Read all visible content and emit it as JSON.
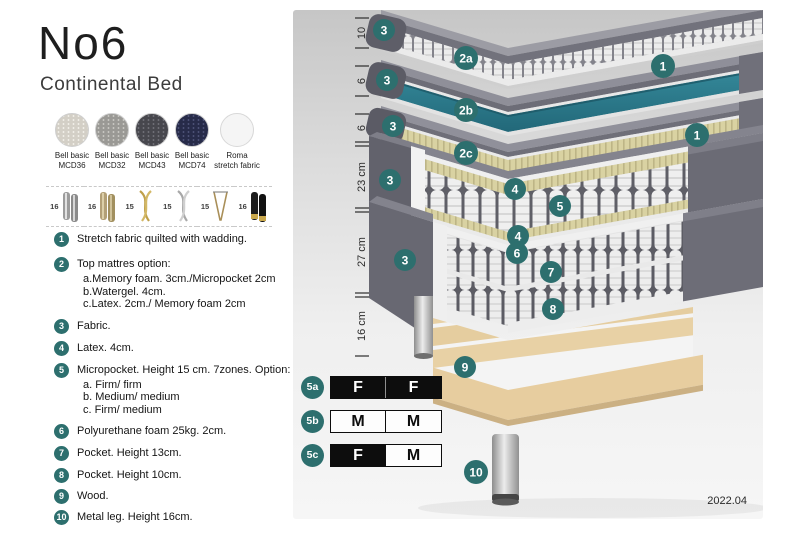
{
  "header": {
    "title": "No6",
    "subtitle": "Continental Bed"
  },
  "fabrics": [
    {
      "line1": "Bell basic",
      "line2": "MCD36"
    },
    {
      "line1": "Bell basic",
      "line2": "MCD32"
    },
    {
      "line1": "Bell basic",
      "line2": "MCD43"
    },
    {
      "line1": "Bell basic",
      "line2": "MCD74"
    },
    {
      "line1": "Roma",
      "line2": "stretch fabric"
    }
  ],
  "legs": [
    {
      "height": "16",
      "icon": "cylinder-silver-leg-icon"
    },
    {
      "height": "16",
      "icon": "cylinder-wood-leg-icon"
    },
    {
      "height": "15",
      "icon": "twist-gold-leg-icon"
    },
    {
      "height": "15",
      "icon": "twist-silver-leg-icon"
    },
    {
      "height": "15",
      "icon": "hairpin-leg-icon"
    },
    {
      "height": "16",
      "icon": "cylinder-black-gold-leg-icon"
    }
  ],
  "features": [
    {
      "num": "1",
      "text": "Stretch fabric quilted with wadding.",
      "sub": []
    },
    {
      "num": "2",
      "text": "Top mattres option:",
      "sub": [
        "a.Memory foam. 3cm./Micropocket 2cm",
        "b.Watergel. 4cm.",
        "c.Latex. 2cm./ Memory foam 2cm"
      ]
    },
    {
      "num": "3",
      "text": "Fabric.",
      "sub": []
    },
    {
      "num": "4",
      "text": "Latex. 4cm.",
      "sub": []
    },
    {
      "num": "5",
      "text": "Micropocket. Height 15 cm. 7zones. Option:",
      "sub": [
        "a. Firm/ firm",
        "b. Medium/ medium",
        "c. Firm/ medium"
      ]
    },
    {
      "num": "6",
      "text": "Polyurethane foam 25kg. 2cm.",
      "sub": []
    },
    {
      "num": "7",
      "text": "Pocket. Height 13cm.",
      "sub": []
    },
    {
      "num": "8",
      "text": "Pocket. Height 10cm.",
      "sub": []
    },
    {
      "num": "9",
      "text": "Wood.",
      "sub": []
    },
    {
      "num": "10",
      "text": "Metal leg. Height 16cm.",
      "sub": []
    }
  ],
  "diagram": {
    "dimensions": [
      "10",
      "6",
      "6",
      "23 cm",
      "27 cm",
      "16 cm"
    ],
    "callouts": [
      {
        "label": "3"
      },
      {
        "label": "2a"
      },
      {
        "label": "1"
      },
      {
        "label": "3"
      },
      {
        "label": "2b"
      },
      {
        "label": "3"
      },
      {
        "label": "2c"
      },
      {
        "label": "1"
      },
      {
        "label": "3"
      },
      {
        "label": "4"
      },
      {
        "label": "5"
      },
      {
        "label": "4"
      },
      {
        "label": "3"
      },
      {
        "label": "6"
      },
      {
        "label": "7"
      },
      {
        "label": "8"
      },
      {
        "label": "9"
      },
      {
        "label": "10"
      }
    ],
    "version": "2022.04",
    "colors": {
      "accent_teal": "#2d6f6e",
      "watergel_teal": "#2e7e8d",
      "fabric_gray": "#6d6d77",
      "latex_tan": "#d9d2a2",
      "wood": "#e8d1a5"
    }
  },
  "firmness": {
    "rows": [
      {
        "label": "5a",
        "cells": [
          {
            "text": "F",
            "style": "dark"
          },
          {
            "text": "F",
            "style": "dark"
          }
        ]
      },
      {
        "label": "5b",
        "cells": [
          {
            "text": "M",
            "style": "light"
          },
          {
            "text": "M",
            "style": "light"
          }
        ]
      },
      {
        "label": "5c",
        "cells": [
          {
            "text": "F",
            "style": "dark"
          },
          {
            "text": "M",
            "style": "light"
          }
        ]
      }
    ]
  }
}
